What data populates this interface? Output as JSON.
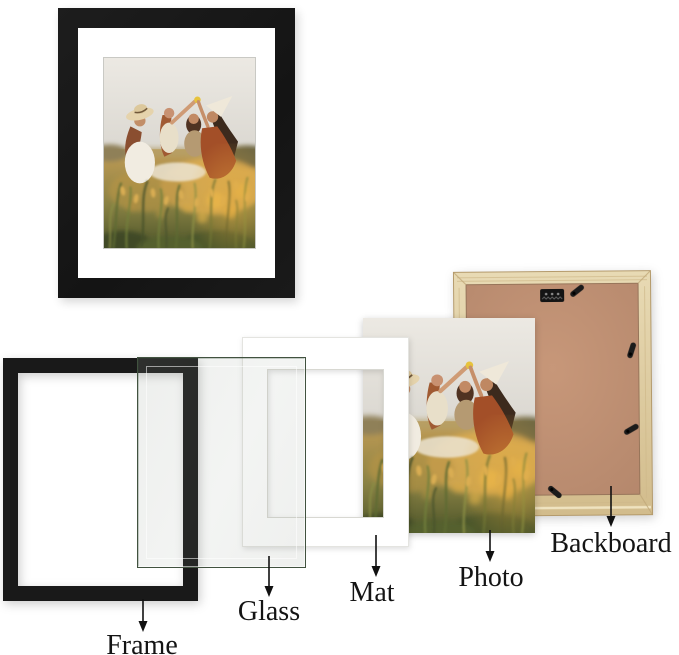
{
  "scene": {
    "type": "picture-frame-parts-diagram",
    "background": "#ffffff",
    "photo_description": "Four women wearing sun hats having a picnic in a sunlit golden grass field"
  },
  "labels": {
    "frame": "Frame",
    "glass": "Glass",
    "mat": "Mat",
    "photo": "Photo",
    "backboard": "Backboard"
  },
  "colors": {
    "frame_black": "#191919",
    "mat_white": "#ffffff",
    "glass_tint": "#f0f2ef",
    "glass_edge": "#41523f",
    "backboard_wood": "#ddc99f",
    "backboard_mdf": "#bf9074",
    "hardware_black": "#1b1b1b",
    "label_text": "#141414"
  }
}
